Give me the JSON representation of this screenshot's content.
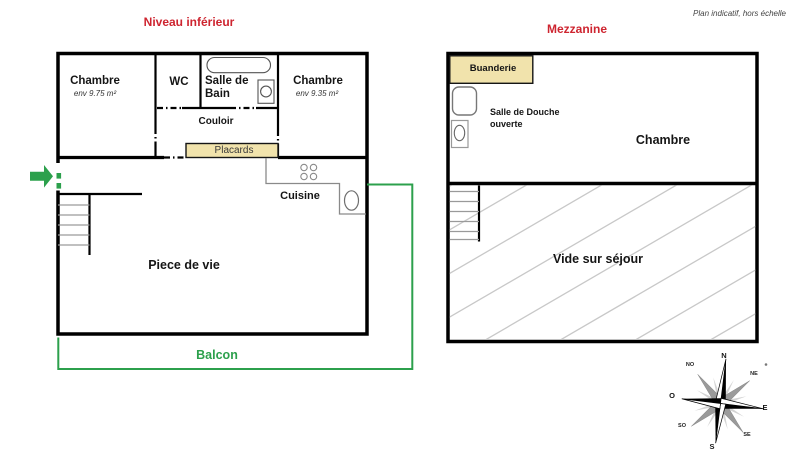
{
  "note": "Plan indicatif, hors échelle",
  "lower": {
    "title": "Niveau inférieur",
    "chambre1": {
      "name": "Chambre",
      "area": "env 9.75 m²"
    },
    "wc": "WC",
    "bain_line1": "Salle de",
    "bain_line2": "Bain",
    "couloir": "Couloir",
    "placards": "Placards",
    "chambre2": {
      "name": "Chambre",
      "area": "env 9.35 m²"
    },
    "cuisine": "Cuisine",
    "piece_de_vie": "Piece de vie",
    "balcon": "Balcon"
  },
  "mezzanine": {
    "title": "Mezzanine",
    "buanderie": "Buanderie",
    "douche_line1": "Salle de Douche",
    "douche_line2": "ouverte",
    "chambre": "Chambre",
    "vide": "Vide sur séjour"
  },
  "compass": {
    "n": "N",
    "e": "E",
    "s": "S",
    "o": "O",
    "ne": "NE",
    "no": "NO",
    "se": "SE",
    "so": "SO"
  },
  "colors": {
    "title_red": "#ce2530",
    "green": "#2ca04c",
    "beige": "#f1e3ac",
    "wall": "#000000",
    "hatch": "#c8c8c8"
  }
}
